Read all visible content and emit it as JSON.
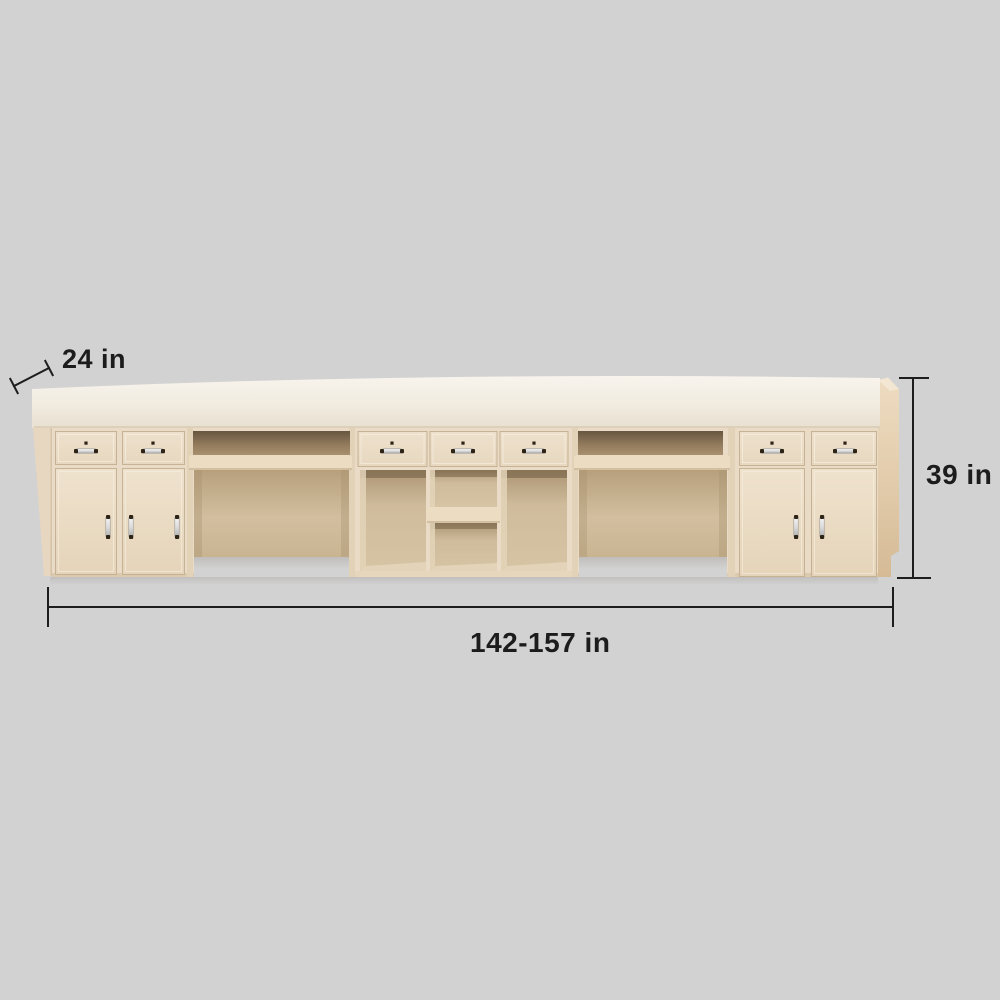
{
  "page": {
    "type": "product-dimension-diagram",
    "background_color": "#d2d2d2"
  },
  "product": {
    "name": "Long reception counter cabinet",
    "finish_colors": {
      "countertop": "#f5f1e9",
      "cabinet_front": "#eaddc7",
      "side_panel": "#ddc6a6",
      "opening_interior": "#a68d6a",
      "handle_chrome": "#d9d9d9",
      "dimension_line": "#1d1d1d"
    },
    "features": {
      "left_cabinet": {
        "drawers": 2,
        "doors": 2
      },
      "middle_unit": {
        "drawers": 3,
        "open_cubbies": 4
      },
      "right_cabinet": {
        "drawers": 2,
        "doors": 2
      },
      "open_knee_spaces": 2
    }
  },
  "dimensions": {
    "depth": {
      "label": "24 in"
    },
    "height": {
      "label": "39 in"
    },
    "width": {
      "label": "142-157 in"
    }
  }
}
